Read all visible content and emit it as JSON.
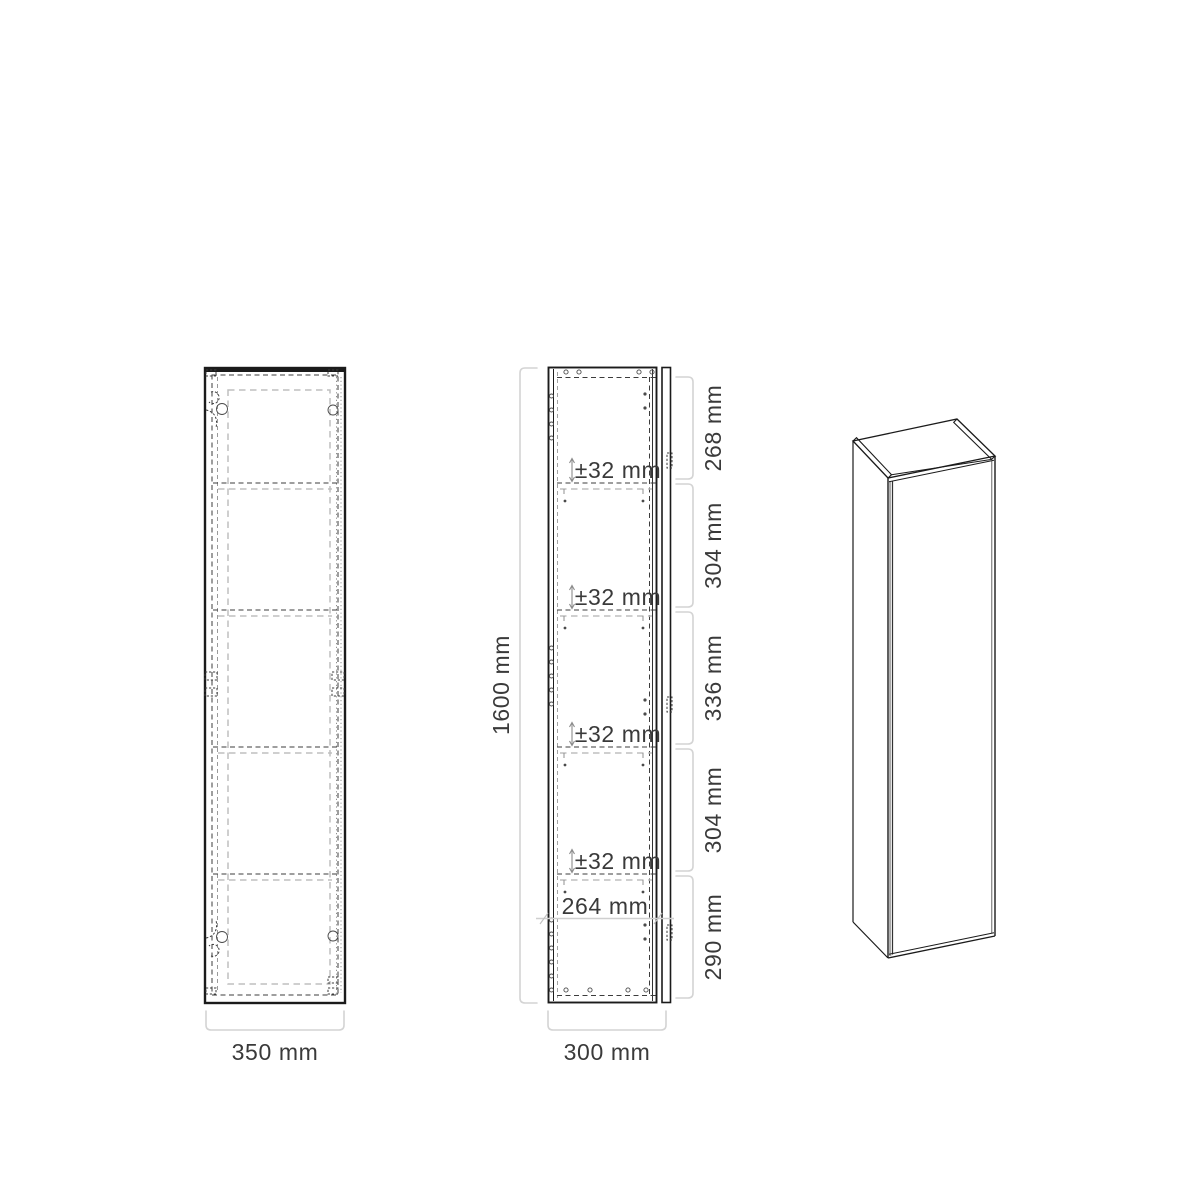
{
  "front_view": {
    "width_label": "350 mm"
  },
  "side_view": {
    "height_label": "1600 mm",
    "depth_label": "300 mm",
    "segment_labels": [
      "268 mm",
      "304 mm",
      "336 mm",
      "304 mm",
      "290 mm"
    ],
    "adjust_labels": [
      "±32 mm",
      "±32 mm",
      "±32 mm",
      "±32 mm"
    ],
    "inner_width_label": "264 mm"
  },
  "colors": {
    "outline": "#1b1b1b",
    "hidden_line": "#3c3c3c",
    "light_line": "#bfbfbf",
    "dimension_bracket": "#d4d4d4",
    "label_text": "#3a3a3a"
  }
}
